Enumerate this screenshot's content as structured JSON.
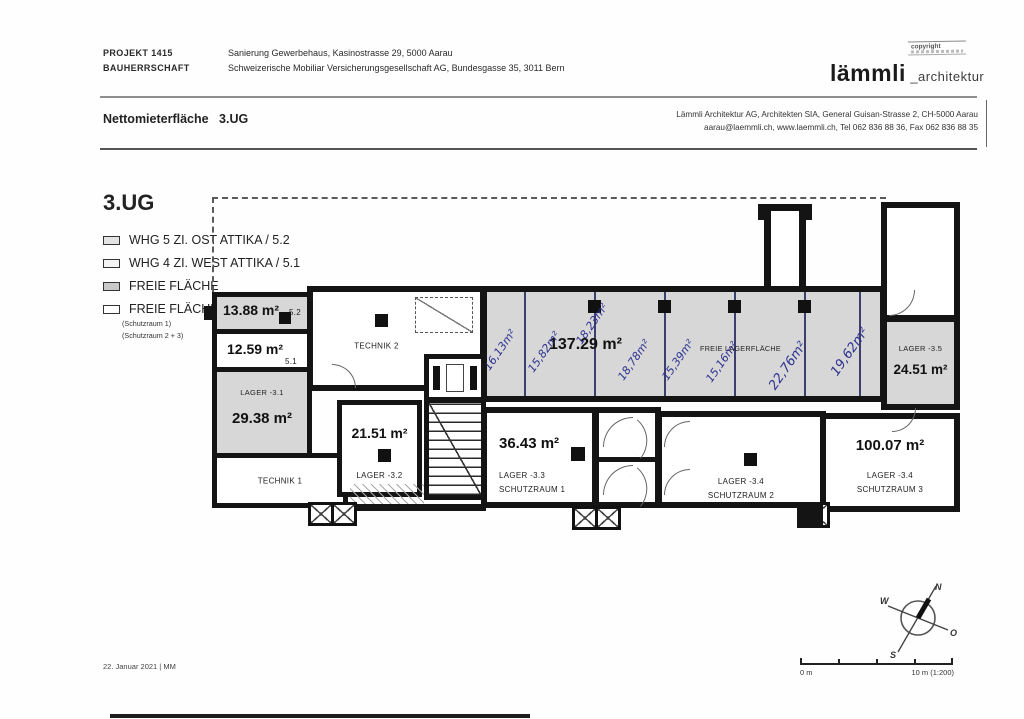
{
  "header": {
    "project_label": "PROJEKT 1415",
    "project_value": "Sanierung Gewerbehaus, Kasinostrasse 29, 5000 Aarau",
    "client_label": "BAUHERRSCHAFT",
    "client_value": "Schweizerische Mobiliar Versicherungsgesellschaft AG, Bundesgasse 35, 3011 Bern",
    "copyright": "copyright",
    "logo": {
      "primary": "lämmli",
      "secondary": "_architektur"
    }
  },
  "titlebar": {
    "doc_title": "Nettomieterfläche",
    "floor": "3.UG",
    "architect_line1": "Lämmli Architektur AG, Architekten SIA, General Guisan-Strasse 2, CH-5000 Aarau",
    "architect_line2": "aarau@laemmli.ch, www.laemmli.ch, Tel 062 836 88 36, Fax 062 836 88 35"
  },
  "legend": {
    "floor_title": "3.UG",
    "items": [
      {
        "label": "WHG 5 ZI. OST ATTIKA / 5.2",
        "swatch": "#e4e4e4"
      },
      {
        "label": "WHG 4 ZI. WEST ATTIKA / 5.1",
        "swatch": "#f4f4f4"
      },
      {
        "label": "FREIE FLÄCHE",
        "swatch": "#c9c9c9"
      },
      {
        "label": "FREIE FLÄCHE",
        "swatch": "#ffffff"
      }
    ],
    "item4_sub1": "(Schutzraum 1)",
    "item4_sub2": "(Schutzraum 2 + 3)"
  },
  "plan": {
    "colors": {
      "wall": "#141414",
      "free_area_fill": "#d7d7d7",
      "handwriting_ink": "#2d3190"
    },
    "rooms": {
      "attika52": {
        "area": "13.88 m²",
        "unit": "5.2"
      },
      "attika51": {
        "area": "12.59 m²",
        "unit": "5.1"
      },
      "lager31": {
        "name": "LAGER  -3.1",
        "area": "29.38 m²"
      },
      "technik1": {
        "name": "TECHNIK 1"
      },
      "technik2": {
        "name": "TECHNIK 2"
      },
      "lager32": {
        "area": "21.51 m²",
        "name": "LAGER  -3.2"
      },
      "hall": {
        "area": "137.29 m²",
        "name": "FREIE LAGERFLÄCHE"
      },
      "lager33": {
        "area": "36.43 m²",
        "name": "LAGER  -3.3",
        "sub": "SCHUTZRAUM 1"
      },
      "lager34a": {
        "name": "LAGER  -3.4",
        "sub": "SCHUTZRAUM 2"
      },
      "lager34b": {
        "area": "100.07 m²",
        "name": "LAGER  -3.4",
        "sub": "SCHUTZRAUM 3"
      },
      "lager35": {
        "name": "LAGER  -3.5",
        "area": "24.51 m²"
      }
    },
    "annotations": [
      "16,13m²",
      "15,82m²",
      "18,23m²",
      "18,78m²",
      "15,39m²",
      "15,16m²",
      "22,76m²",
      "19,62m²"
    ]
  },
  "footer": {
    "date": "22. Januar 2021 | MM",
    "scale_start": "0 m",
    "scale_end": "10 m (1:200)",
    "compass": {
      "n": "N",
      "w": "W",
      "o": "O",
      "s": "S"
    }
  }
}
